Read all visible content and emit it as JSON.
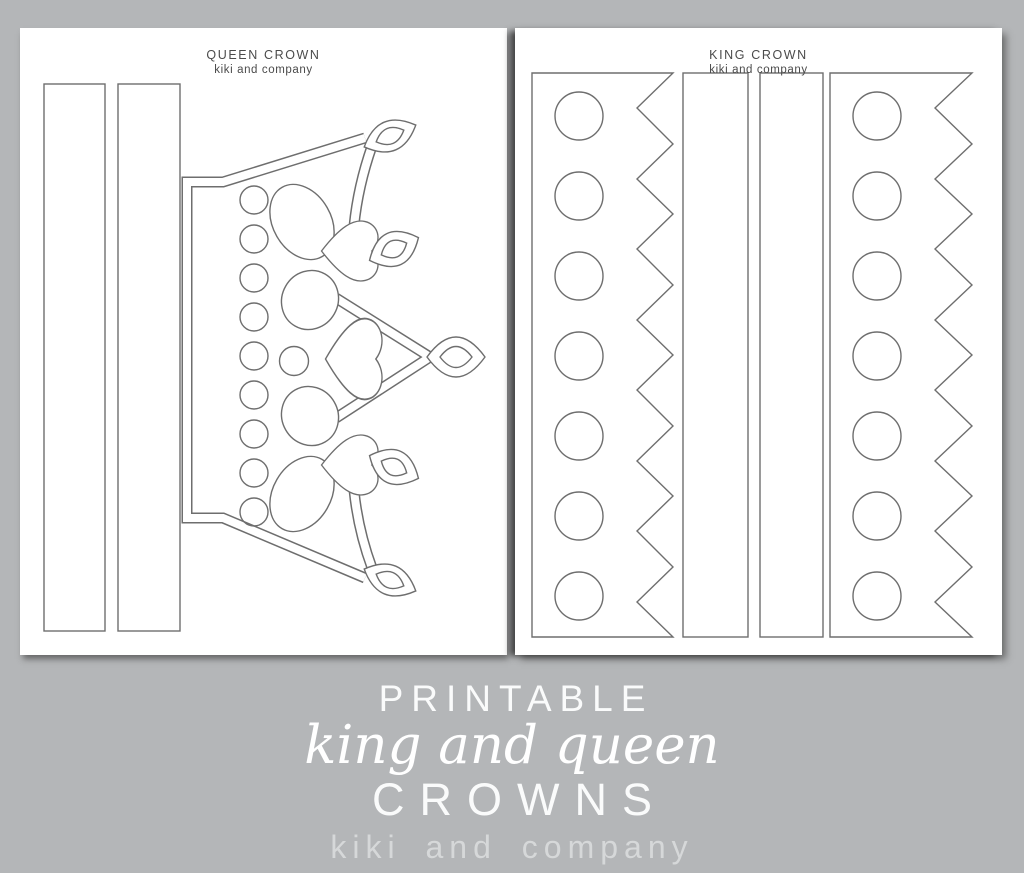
{
  "queen_page": {
    "title": "QUEEN CROWN",
    "subtitle": "kiki and company"
  },
  "king_page": {
    "title": "KING CROWN",
    "subtitle": "kiki and company"
  },
  "caption": {
    "line1": "PRINTABLE",
    "line2": "king and queen",
    "line3": "CROWNS",
    "line4": "kiki and company"
  },
  "colors": {
    "background": "#b4b6b8",
    "page": "#ffffff",
    "template_line": "#6e6e6e",
    "caption_text": "#fafbfb",
    "caption_muted": "#d6d8d9",
    "header_text": "#4b4b4b"
  }
}
